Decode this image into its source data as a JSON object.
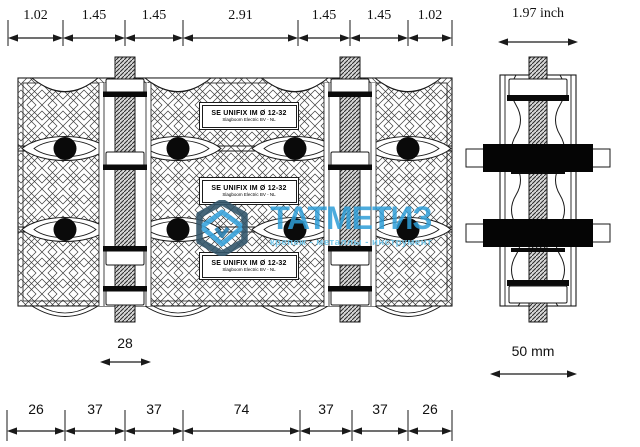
{
  "watermark": {
    "brand": "ТАТМЕТИЗ",
    "tagline": "крепеж - металлы - инструмент",
    "logo": "hexagon-logo",
    "colors": {
      "brand": "#2E9ED8",
      "tagline": "#72C7EA",
      "logo_dark": "#33566B",
      "logo_accent": "#3AA4DC",
      "logo_inner": "#2B7FB0"
    }
  },
  "product_label": {
    "line1": "SE UNIFIX IM Ø 12-32",
    "line2": "Slagboom Electric BV - NL"
  },
  "dimensions": {
    "top": {
      "unit": "inch",
      "segments": [
        "1.02",
        "1.45",
        "1.45",
        "2.91",
        "1.45",
        "1.45",
        "1.02"
      ]
    },
    "bottom": {
      "unit": "mm",
      "segments": [
        "26",
        "37",
        "37",
        "74",
        "37",
        "37",
        "26"
      ]
    },
    "side_width_top": "1.97 inch",
    "side_width_bottom": "50 mm",
    "stud_width": "28"
  }
}
